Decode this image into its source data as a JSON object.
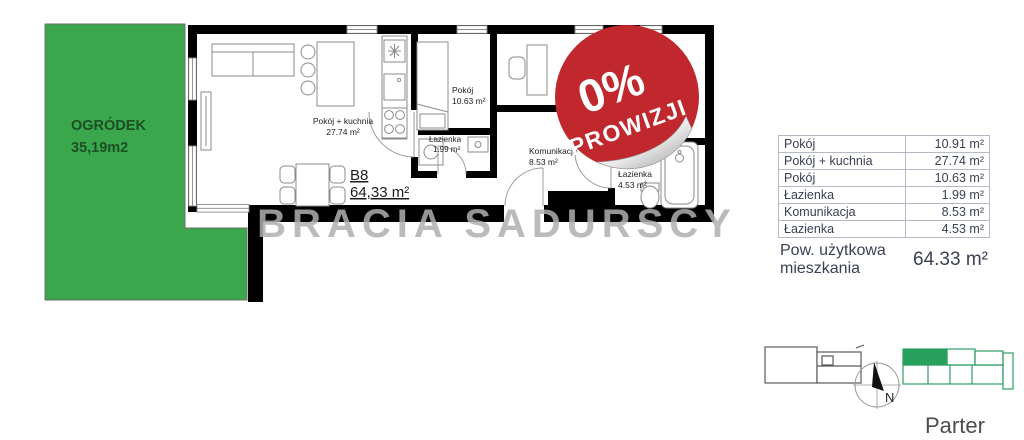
{
  "garden": {
    "name": "OGRÓDEK",
    "area": "35,19m2"
  },
  "unit": {
    "code": "B8",
    "area": "64,33 m²"
  },
  "plan_rooms": {
    "livingroom": {
      "name": "Pokój + kuchnia",
      "area": "27.74 m²"
    },
    "bedroom": {
      "name": "Pokój",
      "area": "10.63 m²"
    },
    "bathroom_small": {
      "name": "Łazienka",
      "area": "1.99 m²"
    },
    "hall": {
      "name": "Komunikacja",
      "area": "8.53 m²"
    },
    "bathroom_large": {
      "name": "Łazienka",
      "area": "4.53 m²"
    }
  },
  "badge": {
    "percent": "0%",
    "text": "PROWIZJI"
  },
  "watermark": "BRACIA SADURSCY",
  "area_table": {
    "rows": [
      {
        "name": "Pokój",
        "value": "10.91 m²"
      },
      {
        "name": "Pokój + kuchnia",
        "value": "27.74 m²"
      },
      {
        "name": "Pokój",
        "value": "10.63 m²"
      },
      {
        "name": "Łazienka",
        "value": "1.99 m²"
      },
      {
        "name": "Komunikacja",
        "value": "8.53 m²"
      },
      {
        "name": "Łazienka",
        "value": "4.53 m²"
      }
    ],
    "total_label": "Pow. użytkowa mieszkania",
    "total_value": "64.33 m²"
  },
  "compass": {
    "north": "N"
  },
  "floor": {
    "label": "Parter"
  },
  "colors": {
    "garden_fill": "#3ba74c",
    "garden_text": "#1b4f26",
    "badge_red": "#c1282d",
    "footprint_highlight": "#27a05c",
    "wall_black": "#000000"
  }
}
